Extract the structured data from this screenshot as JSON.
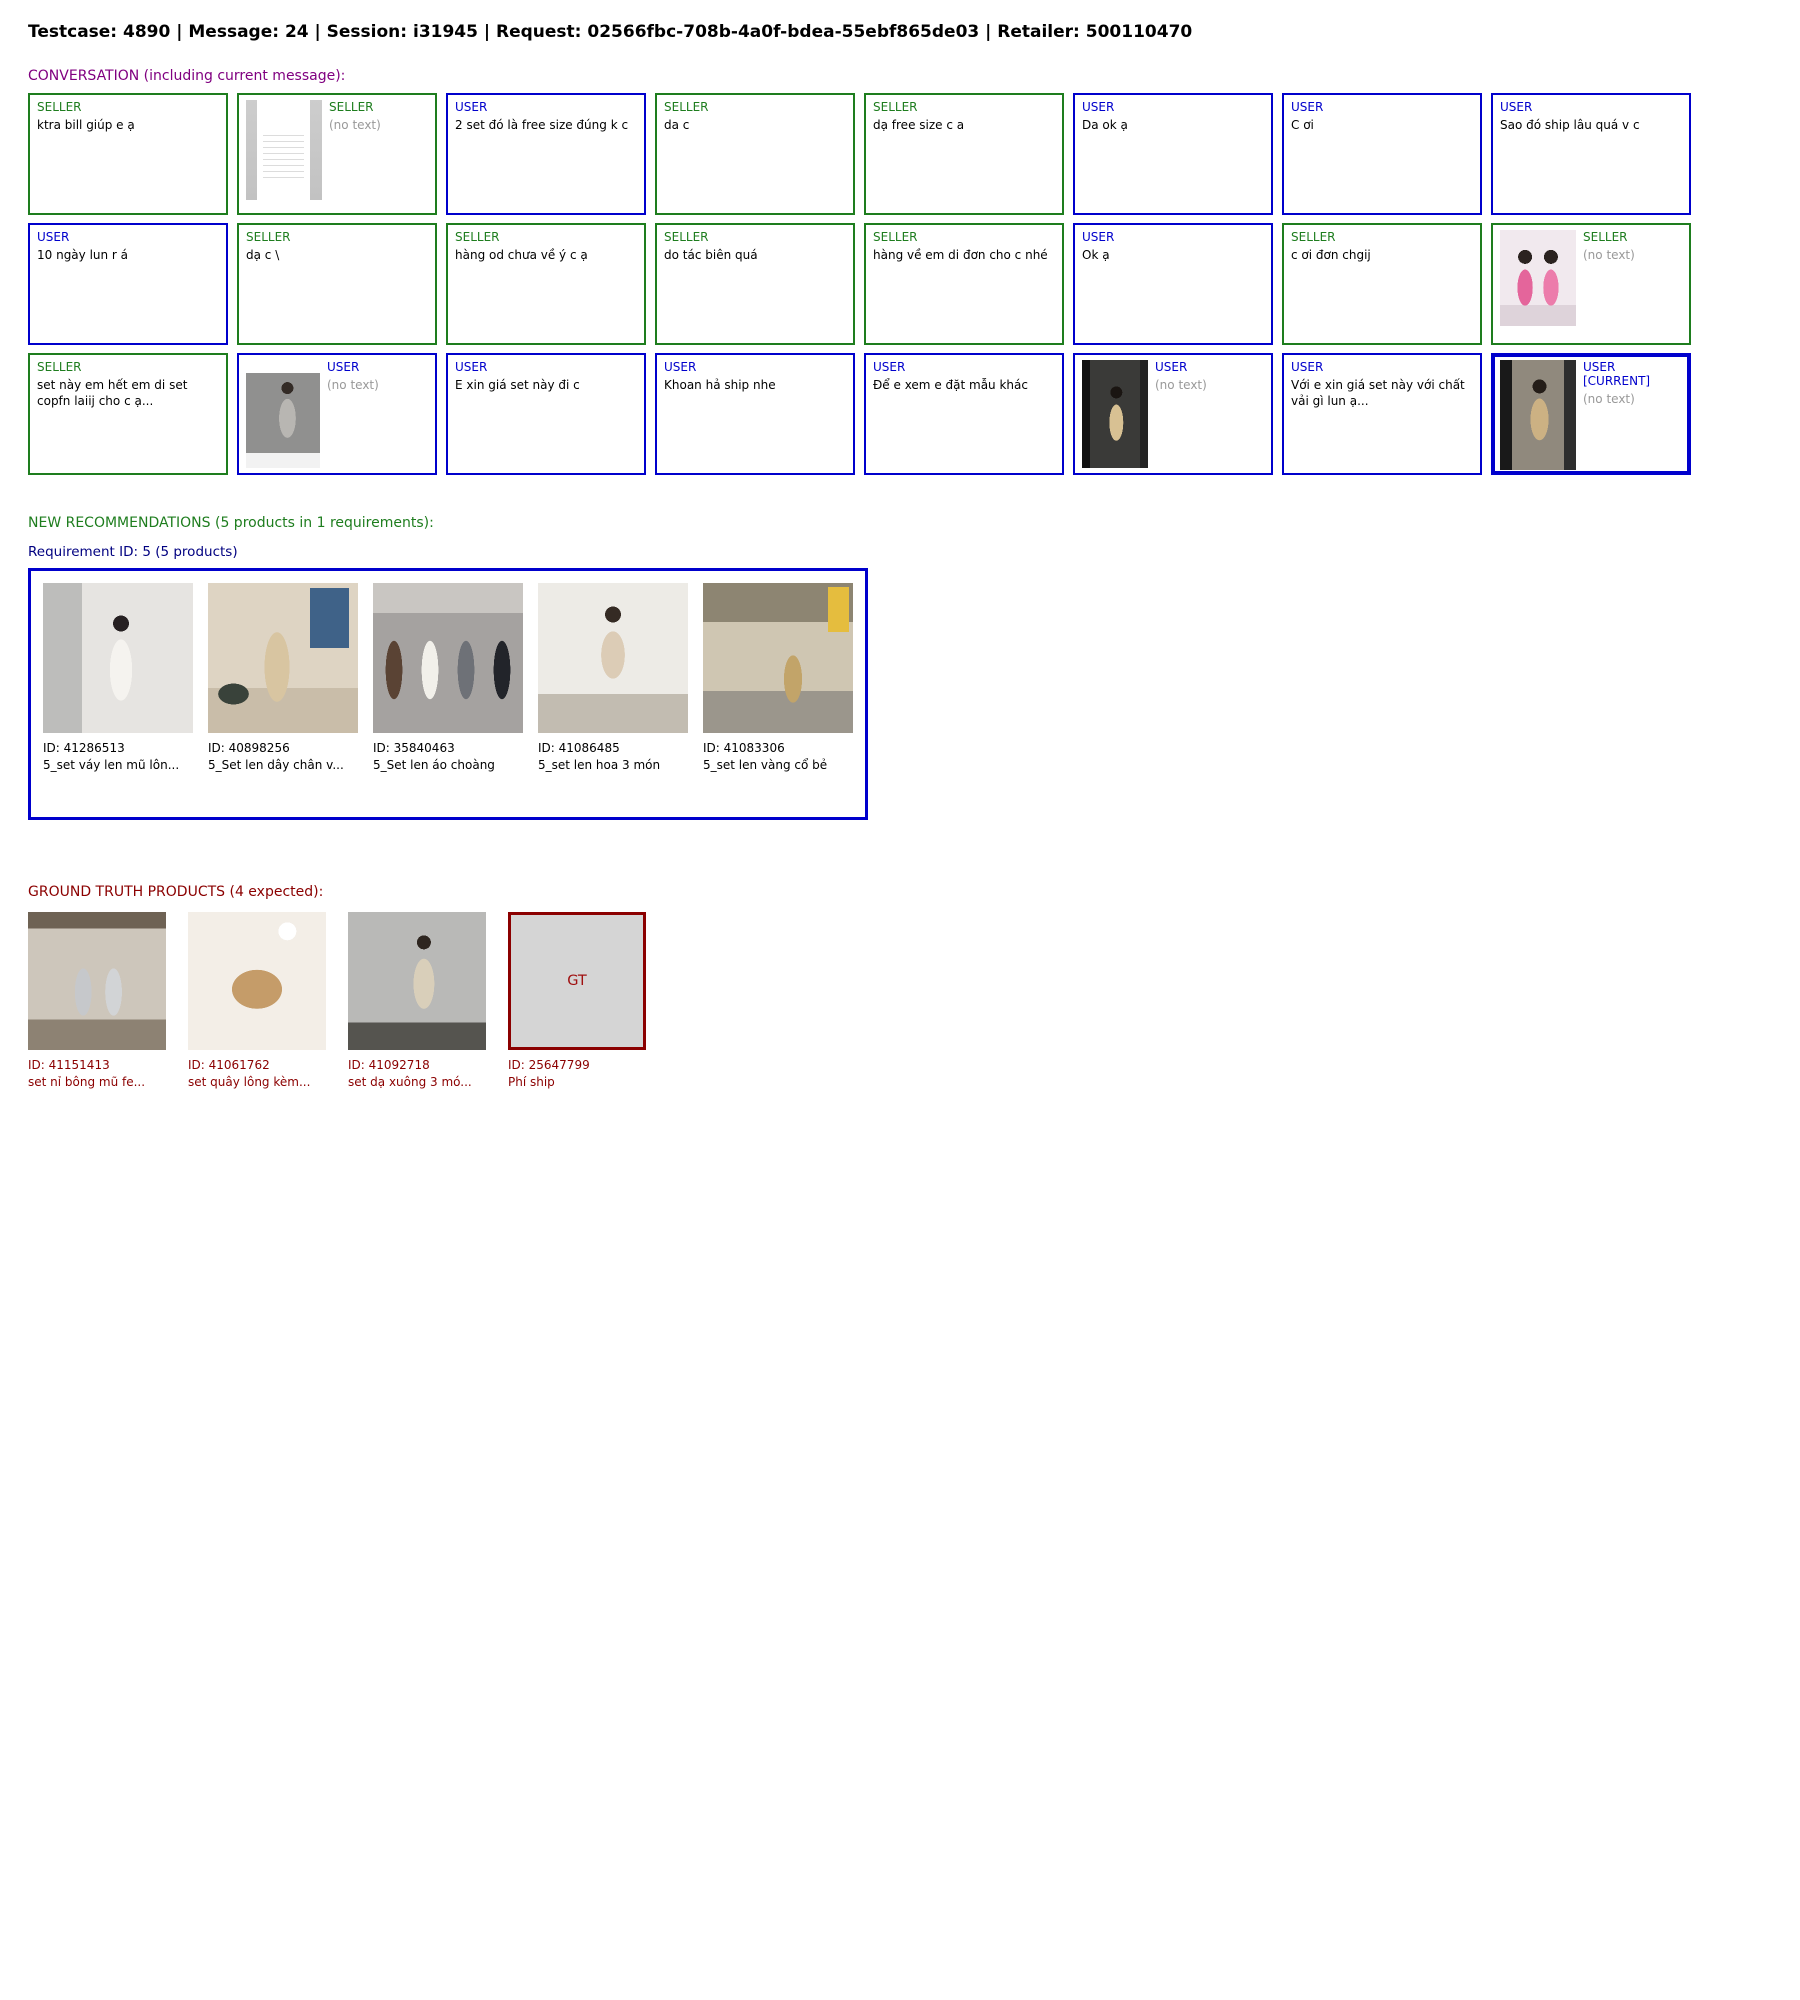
{
  "header": {
    "title": "Testcase: 4890 | Message: 24 | Session: i31945 | Request: 02566fbc-708b-4a0f-bdea-55ebf865de03 | Retailer: 500110470"
  },
  "colors": {
    "seller_green": "#1e7d1e",
    "user_blue": "#0000cc",
    "conversation_purple": "#800080",
    "requirement_navy": "#000080",
    "ground_truth_dark_red": "#8b0000",
    "no_text_grey": "#999999",
    "placeholder_grey": "#d5d5d5"
  },
  "conversation": {
    "heading": "CONVERSATION (including current message):",
    "messages": [
      {
        "role": "seller",
        "label": "SELLER",
        "text": "ktra bill giúp e ạ"
      },
      {
        "role": "seller",
        "label": "SELLER",
        "text": null,
        "no_text_label": "(no text)",
        "image": "receipt"
      },
      {
        "role": "user",
        "label": "USER",
        "text": "2 set đó là free size đúng k c"
      },
      {
        "role": "seller",
        "label": "SELLER",
        "text": "da c"
      },
      {
        "role": "seller",
        "label": "SELLER",
        "text": "dạ free size c a"
      },
      {
        "role": "user",
        "label": "USER",
        "text": "Da ok ạ"
      },
      {
        "role": "user",
        "label": "USER",
        "text": "C ơi"
      },
      {
        "role": "user",
        "label": "USER",
        "text": "Sao đó ship lâu quá v c"
      },
      {
        "role": "user",
        "label": "USER",
        "text": "10 ngày lun r á"
      },
      {
        "role": "seller",
        "label": "SELLER",
        "text": "dạ c \\"
      },
      {
        "role": "seller",
        "label": "SELLER",
        "text": "hàng od chưa về ý c ạ"
      },
      {
        "role": "seller",
        "label": "SELLER",
        "text": "do tác biên quá"
      },
      {
        "role": "seller",
        "label": "SELLER",
        "text": "hàng về em di đơn cho c nhé"
      },
      {
        "role": "user",
        "label": "USER",
        "text": "Ok ạ"
      },
      {
        "role": "seller",
        "label": "SELLER",
        "text": "c ơi đơn chgij"
      },
      {
        "role": "seller",
        "label": "SELLER",
        "text": null,
        "no_text_label": "(no text)",
        "image": "pajama"
      },
      {
        "role": "seller",
        "label": "SELLER",
        "text": "set này em hết em di set copfn laiij cho c ạ..."
      },
      {
        "role": "user",
        "label": "USER",
        "text": null,
        "no_text_label": "(no text)",
        "image": "outfit-shot"
      },
      {
        "role": "user",
        "label": "USER",
        "text": "E xin giá set này đi c"
      },
      {
        "role": "user",
        "label": "USER",
        "text": "Khoan hả ship nhe"
      },
      {
        "role": "user",
        "label": "USER",
        "text": "Để e xem e đặt mẫu khác"
      },
      {
        "role": "user",
        "label": "USER",
        "text": null,
        "no_text_label": "(no text)",
        "image": "store-video"
      },
      {
        "role": "user",
        "label": "USER",
        "text": "Với e xin giá set này với chất vải gì lun ạ..."
      },
      {
        "role": "user",
        "label": "USER [CURRENT]",
        "current": true,
        "text": null,
        "no_text_label": "(no text)",
        "image": "dress-video"
      }
    ]
  },
  "recommendations": {
    "heading": "NEW RECOMMENDATIONS (5 products in 1 requirements):",
    "requirement_heading": "Requirement ID: 5 (5 products)",
    "products": [
      {
        "id_label": "ID: 41286513",
        "name": "5_set váy len mũ lôn...",
        "image": "rec-1"
      },
      {
        "id_label": "ID: 40898256",
        "name": "5_Set len dây chân v...",
        "image": "rec-2"
      },
      {
        "id_label": "ID: 35840463",
        "name": "5_Set len áo choàng",
        "image": "rec-3"
      },
      {
        "id_label": "ID: 41086485",
        "name": "5_set len hoa 3 món",
        "image": "rec-4"
      },
      {
        "id_label": "ID: 41083306",
        "name": "5_set len vàng cổ bẻ",
        "image": "rec-5"
      }
    ]
  },
  "ground_truth": {
    "heading": "GROUND TRUTH PRODUCTS (4 expected):",
    "products": [
      {
        "id_label": "ID: 41151413",
        "name": "set nỉ bông mũ fe...",
        "image": "gt-1"
      },
      {
        "id_label": "ID: 41061762",
        "name": "set quây lông kèm...",
        "image": "gt-2"
      },
      {
        "id_label": "ID: 41092718",
        "name": "set dạ xuông 3 mó...",
        "image": "gt-3"
      },
      {
        "id_label": "ID: 25647799",
        "name": "Phí ship",
        "placeholder": "GT"
      }
    ]
  }
}
